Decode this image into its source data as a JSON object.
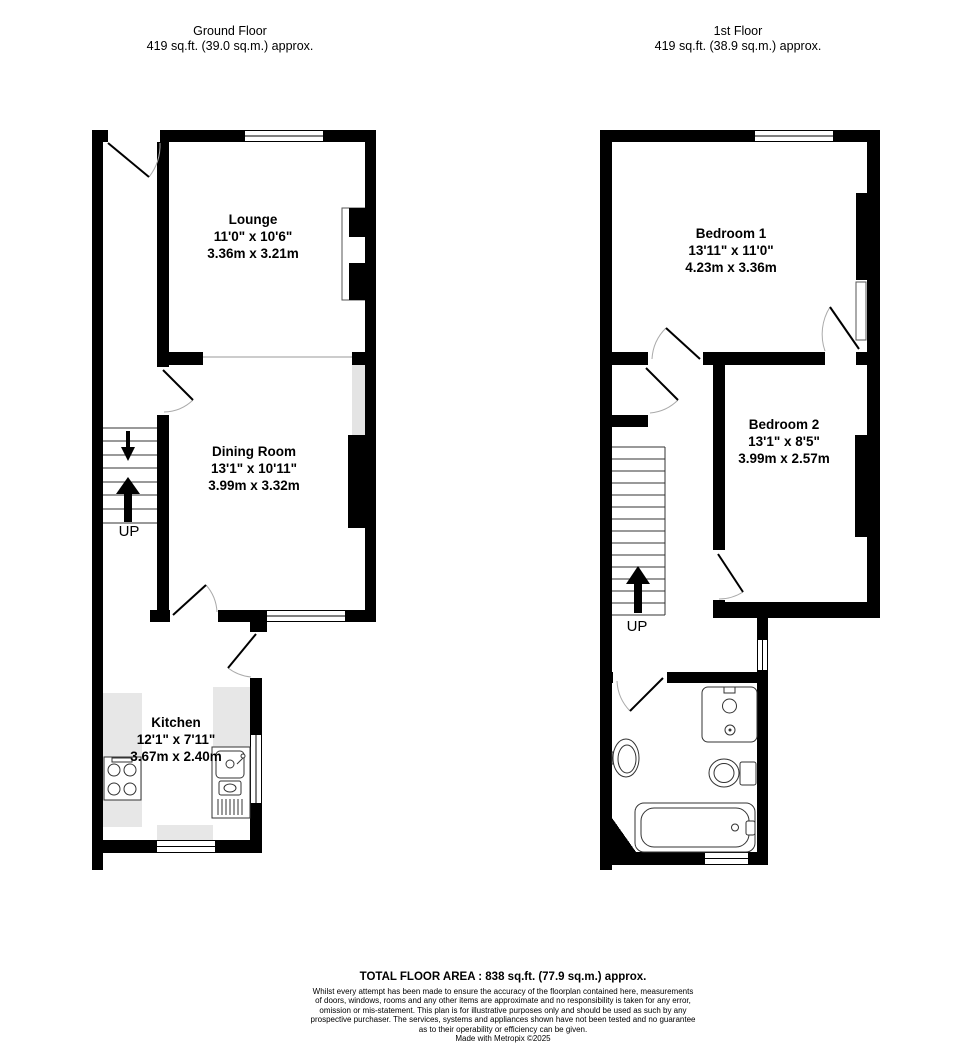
{
  "ground_floor": {
    "title": "Ground Floor",
    "area_line": "419 sq.ft. (39.0 sq.m.) approx.",
    "stairs_label": "UP",
    "rooms": {
      "lounge": {
        "name": "Lounge",
        "dims_imperial": "11'0\" x 10'6\"",
        "dims_metric": "3.36m x 3.21m"
      },
      "dining": {
        "name": "Dining Room",
        "dims_imperial": "13'1\" x 10'11\"",
        "dims_metric": "3.99m x 3.32m"
      },
      "kitchen": {
        "name": "Kitchen",
        "dims_imperial": "12'1\" x 7'11\"",
        "dims_metric": "3.67m x 2.40m"
      }
    },
    "fixtures": [
      "cooker",
      "kitchen-sink",
      "stairs-up"
    ]
  },
  "first_floor": {
    "title": "1st Floor",
    "area_line": "419 sq.ft. (38.9 sq.m.) approx.",
    "stairs_label": "UP",
    "rooms": {
      "bedroom1": {
        "name": "Bedroom 1",
        "dims_imperial": "13'11\" x 11'0\"",
        "dims_metric": "4.23m x 3.36m"
      },
      "bedroom2": {
        "name": "Bedroom 2",
        "dims_imperial": "13'1\" x 8'5\"",
        "dims_metric": "3.99m x 2.57m"
      }
    },
    "fixtures": [
      "shower",
      "basin",
      "toilet",
      "bath",
      "stairs-up"
    ]
  },
  "footer": {
    "total_area": "TOTAL FLOOR AREA : 838 sq.ft. (77.9 sq.m.) approx.",
    "disclaimer_lines": {
      "l1": "Whilst every attempt has been made to ensure the accuracy of the floorplan contained here, measurements",
      "l2": "of doors, windows, rooms and any other items are approximate and no responsibility is taken for any error,",
      "l3": "omission or mis-statement. This plan is for illustrative purposes only and should be used as such by any",
      "l4": "prospective purchaser. The services, systems and appliances shown have not been tested and no guarantee",
      "l5": "as to their operability or efficiency can be given."
    },
    "credit": "Made with Metropix ©2025"
  },
  "colors": {
    "wall": "#000000",
    "counter": "#e7e7e7",
    "alcove": "#e4e4e4",
    "background": "#ffffff"
  }
}
